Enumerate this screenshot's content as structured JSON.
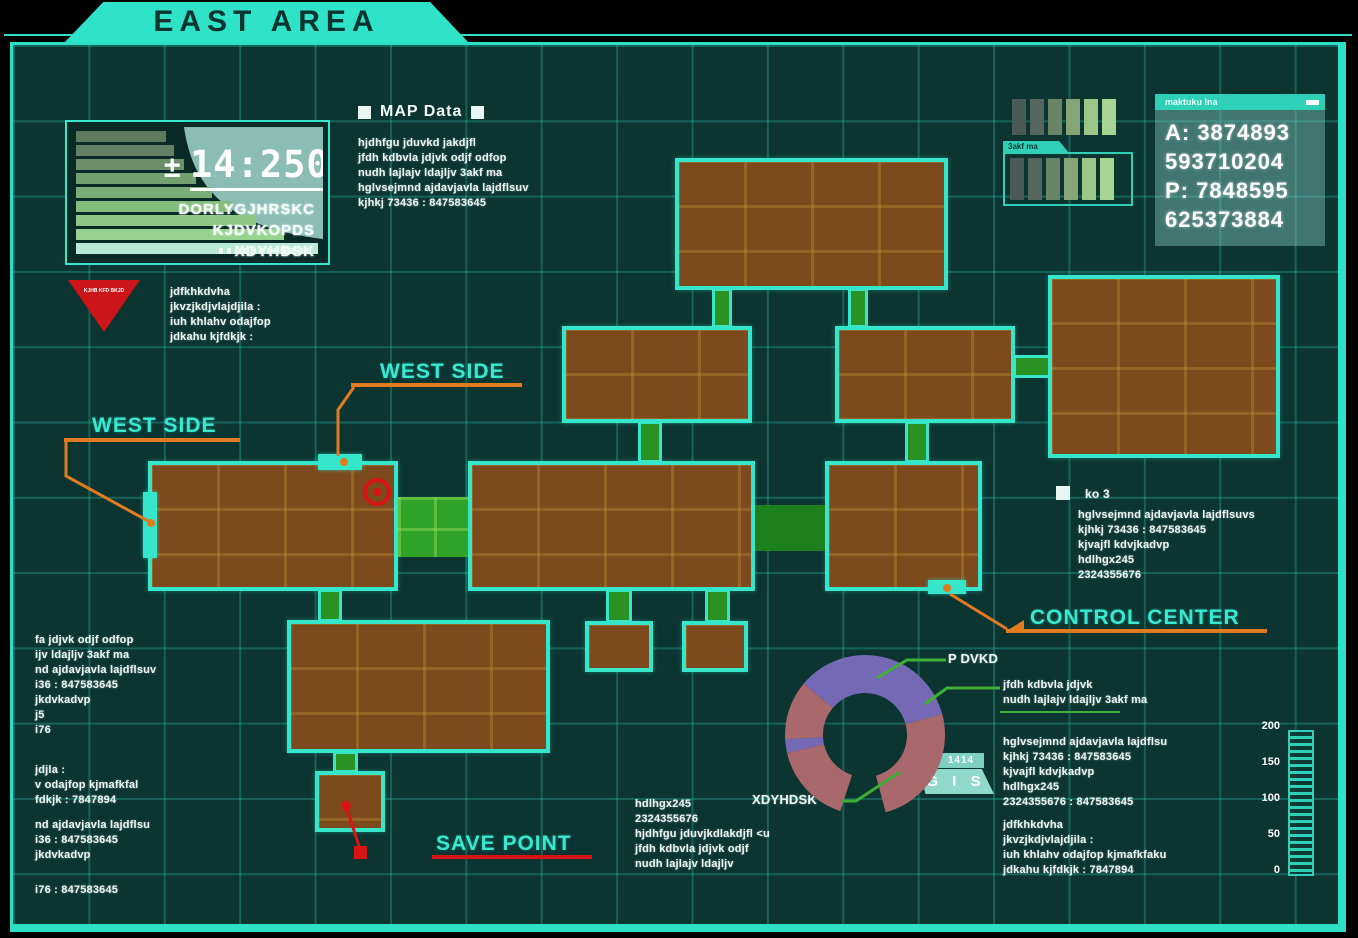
{
  "banner": {
    "title": "EAST AREA"
  },
  "clock_panel": {
    "sign": "±",
    "time": "14:2501",
    "lines": [
      "DORLYGJHRSKC",
      "KJDVKOPDS",
      "XDYHDSK"
    ],
    "bar_colors": [
      "#5d7a60",
      "#637f64",
      "#6c8f69",
      "#73a06e",
      "#7bae74",
      "#83bb7a",
      "#8cc884",
      "#96d38e",
      "#b9e8d6"
    ]
  },
  "map_data": {
    "title": "MAP Data",
    "lines": [
      "hjdhfgu jduvkd jakdjfl",
      "jfdh kdbvla jdjvk odjf odfop",
      "nudh lajlajv ldajljv 3akf ma",
      "hglvsejmnd ajdavjavla lajdflsuv",
      "kjhkj 73436  : 847583645"
    ]
  },
  "warning": {
    "triangle_text": "KJHB KFD BKJD",
    "lines": [
      "jdfkhkdvha",
      "jkvzjkdjvlajdjila :",
      "iuh khlahv odajfop",
      "jdkahu kjfdkjk  :"
    ]
  },
  "meters": {
    "group1_colors": [
      "#4a5a57",
      "#55665f",
      "#6a8468",
      "#85a577",
      "#9cc687",
      "#a8d492"
    ],
    "group2_tab": "3akf ma",
    "group2_colors": [
      "#4a5a57",
      "#55665f",
      "#6a8468",
      "#85a577",
      "#9cc687",
      "#a8d492"
    ]
  },
  "info_panel": {
    "header": "maktuku lna",
    "lines": [
      "A: 3874893",
      "593710204",
      "P: 7848595",
      "625373884"
    ]
  },
  "ko_panel": {
    "title": "ko 3",
    "lines": [
      "hglvsejmnd ajdavjavla lajdflsuvs",
      "kjhkj 73436  : 847583645",
      "kjvajfl kdvjkadvp",
      "hdlhgx245",
      "2324355676"
    ]
  },
  "callouts": {
    "west_side_top": "WEST SIDE",
    "west_side_left": "WEST SIDE",
    "control_center": "CONTROL CENTER",
    "save_point": "SAVE POINT"
  },
  "donut": {
    "label_top": "P DVKD",
    "label_bottom": "XDYHDSK",
    "badge_value": "1414",
    "badge_label": "G I S",
    "callout_lines": [
      "jfdh kdbvla jdjvk",
      "nudh lajlajv ldajljv 3akf ma"
    ],
    "segments": [
      {
        "label": "P DVKD",
        "color": "#7568b4",
        "approx_pct": 36
      },
      {
        "label": "XDYHDSK",
        "color": "#a8686c",
        "approx_pct": 64
      }
    ]
  },
  "bottom_right": {
    "block_a": [
      "hglvsejmnd ajdavjavla lajdflsu",
      "kjhkj 73436  : 847583645",
      "kjvajfl kdvjkadvp",
      "hdlhgx245",
      "2324355676 : 847583645"
    ],
    "block_b": [
      "jdfkhkdvha",
      "jkvzjkdjvlajdjila :",
      "iuh khlahv odajfop kjmafkfaku",
      "jdkahu kjfdkjk  : 7847894"
    ]
  },
  "scale": {
    "ticks": [
      "200",
      "150",
      "100",
      "50",
      "0"
    ]
  },
  "left_column": {
    "block1": [
      "fa jdjvk odjf odfop",
      "ijv ldajljv 3akf ma",
      "nd ajdavjavla lajdflsuv",
      "i36  : 847583645",
      "jkdvkadvp",
      "j5",
      "i76"
    ],
    "block2": [
      "jdjla :",
      "v odajfop kjmafkfal",
      "fdkjk  : 7847894"
    ],
    "block3": [
      "nd ajdavjavla lajdflsu",
      "i36  : 847583645",
      "jkdvkadvp"
    ],
    "block4": [
      "i76 : 847583645"
    ]
  },
  "bottom_center": {
    "lines": [
      "hdlhgx245",
      "2324355676",
      "hjdhfgu jduvjkdlakdjfl <u",
      "jfdh kdbvla jdjvk odjf",
      "nudh lajlajv ldajljv"
    ]
  },
  "colors": {
    "accent_teal": "#2be0c6",
    "label_teal": "#38e9d2",
    "orange": "#e07b20",
    "red": "#d91414",
    "room_brown": "#7c4a1d",
    "corridor_green": "#2fa328",
    "donut_purple": "#7568b4",
    "donut_mauve": "#a8686c"
  }
}
